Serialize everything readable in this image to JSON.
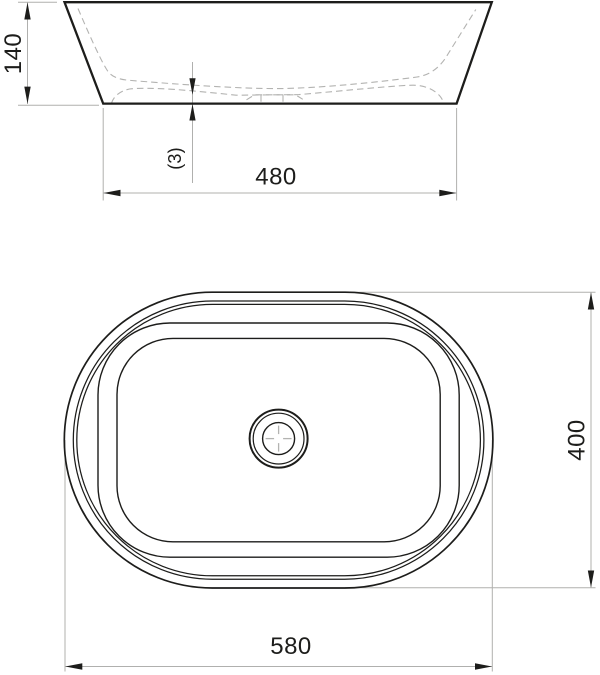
{
  "colors": {
    "ink": "#1d1d1b",
    "construction_line": "#b0b0ae",
    "hidden_line": "#b3b3b1",
    "background": "#ffffff"
  },
  "side_view": {
    "dims": {
      "height": "140",
      "bottom_thickness": "(3)",
      "base_width": "480"
    }
  },
  "top_view": {
    "dims": {
      "overall_width": "580",
      "overall_depth": "400"
    }
  }
}
